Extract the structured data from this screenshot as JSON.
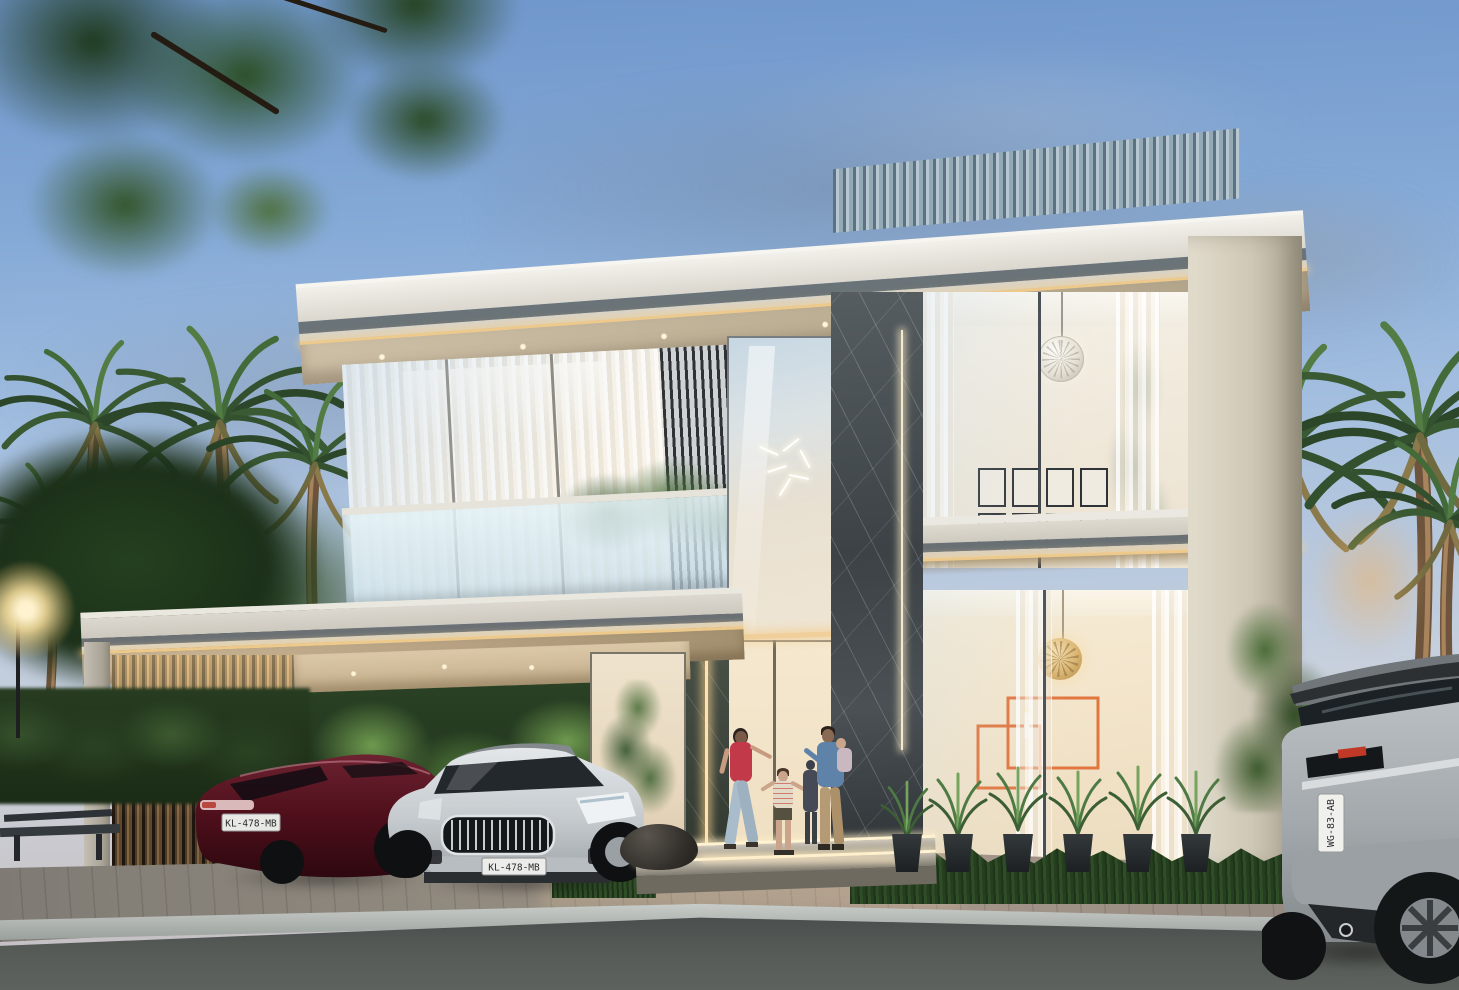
{
  "scene": {
    "description": "Photorealistic dusk rendering of a modern two-storey luxury villa with rooftop louvers, marble-clad entrance, glass facades, a carport with two sedans, palm trees, a family at the entrance and a grey SUV parked on the street",
    "time_of_day": "dusk"
  },
  "palette": {
    "sky_top": "#6f96cb",
    "sky_horizon": "#ccd2dc",
    "roof_white": "#ece9e2",
    "roof_stripe_grey": "#6a7377",
    "soffit_warm": "#cdbfa6",
    "led_warm": "#eec98c",
    "louver_steel_blue": "#a9bdc8",
    "marble_charcoal": "#3f4549",
    "marble_green": "#4d554b",
    "concrete_cream": "#d8d2c4",
    "carport_slat_bronze": "#caa06c",
    "glass_warm_interior": "#f6ead4",
    "accent_art_orange": "#e2763f",
    "foliage_dark_green": "#2c4629",
    "grass_green": "#2f4d26",
    "asphalt_grey": "#4a4f4c"
  },
  "vehicles": {
    "red_sedan": {
      "plate": "KL-478-MB",
      "body_color": "#4e0f1b",
      "location": "carport, left bay, rear view"
    },
    "silver_sedan": {
      "plate": "KL-478-MB",
      "body_color": "#c4c9cd",
      "location": "carport, right bay, front view"
    },
    "grey_suv": {
      "plate": "WG-83-AB",
      "body_color": "#aab0b3",
      "location": "street, right edge, rear view"
    }
  },
  "people": {
    "woman": "woman in red top and light jeans walking toward the entrance",
    "boy": "child in checked shirt holding hands between the adults",
    "dark_child": "second child in dark clothes at the doorway",
    "man": "man in blue shirt and khaki trousers carrying a toddler at the doorway"
  },
  "interior": {
    "upper_floor": "wire sphere pendant light and gallery wall of eight framed pictures",
    "ground_floor": "gold lattice pendant light, orange stepped frame artwork and a candle"
  }
}
